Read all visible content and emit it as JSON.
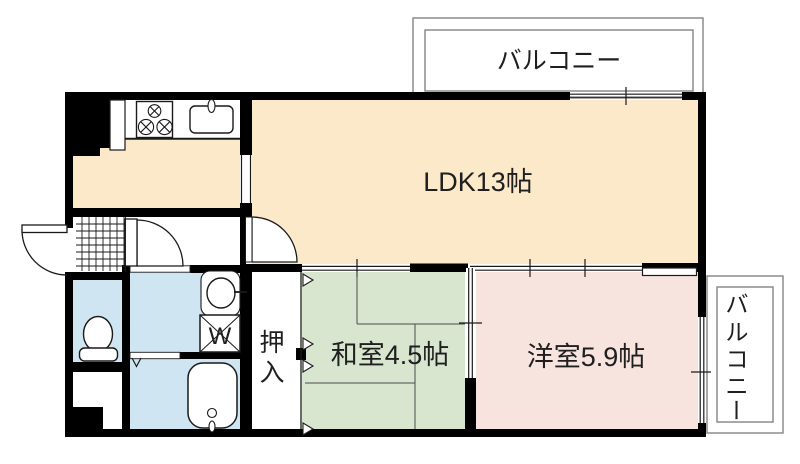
{
  "floor_plan": {
    "rooms": {
      "balcony_top": {
        "label": "バルコニー"
      },
      "balcony_right": {
        "chars": [
          "バ",
          "ル",
          "コ",
          "ニ",
          "ー"
        ]
      },
      "ldk": {
        "label": "LDK13帖"
      },
      "japanese_room": {
        "label": "和室4.5帖"
      },
      "western_room": {
        "label": "洋室5.9帖"
      },
      "closet": {
        "chars": [
          "押",
          "入"
        ]
      },
      "washing_machine": {
        "label": "W"
      }
    },
    "colors": {
      "wall": "#000000",
      "line": "#1a1a1a",
      "ldk_floor": "#FBE9C9",
      "tatami_floor": "#D8E6D0",
      "western_floor": "#F8E4DF",
      "wet_area_floor": "#D0E5F2",
      "balcony_line": "#8C8C8C"
    }
  }
}
